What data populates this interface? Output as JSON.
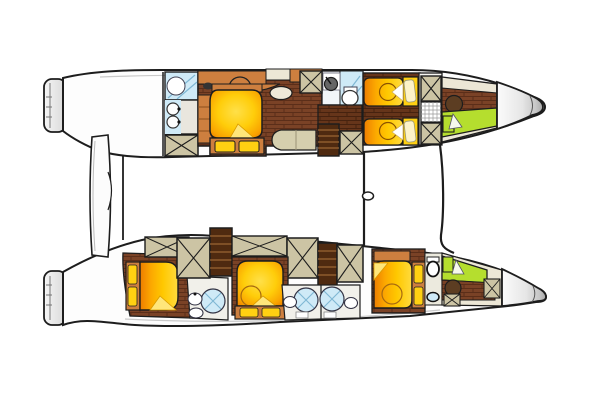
{
  "title": "Catamaran interior deck plan",
  "diagram": {
    "type": "boat-floor-plan",
    "vessel": "sailing catamaran",
    "view": "top-down layout of both hulls",
    "orientation": {
      "bow": "right",
      "stern": "left"
    },
    "upper_hull": {
      "name": "upper hull",
      "rooms": [
        {
          "name": "aft head",
          "fixtures": [
            "shower",
            "washbasin",
            "washbasin",
            "storage-hatch"
          ]
        },
        {
          "name": "owner cabin",
          "fixtures": [
            "island-double-berth",
            "vanity-desk",
            "stool",
            "pouf",
            "dresser",
            "sofa",
            "footboard-cushions",
            "cabinets"
          ]
        },
        {
          "name": "mid head",
          "fixtures": [
            "washbasin",
            "shower",
            "toilet"
          ]
        },
        {
          "name": "companionway",
          "fixtures": [
            "stairs",
            "landing",
            "storage-hatch",
            "storage-hatch"
          ]
        },
        {
          "name": "guest cabin",
          "fixtures": [
            "single-berth",
            "single-berth",
            "pillow",
            "pillow"
          ]
        },
        {
          "name": "locker column",
          "fixtures": [
            "storage-hatch",
            "grid-escape-hatch",
            "storage-hatch"
          ]
        },
        {
          "name": "forepeak crew cabin",
          "fixtures": [
            "deck-hatch",
            "crew-berth",
            "locker",
            "pillow"
          ]
        },
        {
          "name": "bow",
          "fixtures": []
        }
      ]
    },
    "lower_hull": {
      "name": "lower hull",
      "rooms": [
        {
          "name": "aft cabin",
          "fixtures": [
            "double-berth",
            "headboard-cushions"
          ]
        },
        {
          "name": "aft head",
          "fixtures": [
            "shower",
            "washbasin",
            "toilet"
          ]
        },
        {
          "name": "aft companionway",
          "fixtures": [
            "stairs",
            "storage-hatch",
            "storage-hatch",
            "cabinet"
          ]
        },
        {
          "name": "mid cabin",
          "fixtures": [
            "double-berth",
            "footboard-cushions"
          ]
        },
        {
          "name": "twin heads",
          "fixtures": [
            "shower",
            "toilet",
            "shower",
            "toilet"
          ]
        },
        {
          "name": "forward companionway",
          "fixtures": [
            "stairs",
            "storage-hatch",
            "cabinet"
          ]
        },
        {
          "name": "forward cabin",
          "fixtures": [
            "double-berth",
            "headboard-cushions",
            "toilet",
            "washbasin"
          ]
        },
        {
          "name": "forepeak crew cabin",
          "fixtures": [
            "crew-berth",
            "locker",
            "deck-hatch",
            "storage-hatch",
            "storage-hatch",
            "pillow"
          ]
        },
        {
          "name": "bow",
          "fixtures": []
        }
      ]
    },
    "bridge": {
      "elements": [
        "aft-platform-panel",
        "aft-bridge-edge-line",
        "mast-line",
        "mast-line-shackle",
        "forward-beam-line"
      ]
    }
  },
  "colors": {
    "canvas": "#ffffff",
    "outline": "#1d1d1d",
    "hull-white": "#fdfdfd",
    "bow-shade": "#b0b0b0",
    "floor-brown": "#7a4226",
    "floor-brown-dark": "#66351a",
    "cabinet-orange": "#cd7f3f",
    "bed-yellow": "#ffd012",
    "bed-orange": "#ee8600",
    "hatch-tan": "#ccc4a4",
    "bath-blue": "#cfeaf7",
    "bunk-green": "#b5de2e",
    "sofa-khaki": "#d5cfae",
    "cream": "#ece7d6",
    "stairs-brown": "#4f2a10",
    "fixture-white": "#ffffff"
  }
}
